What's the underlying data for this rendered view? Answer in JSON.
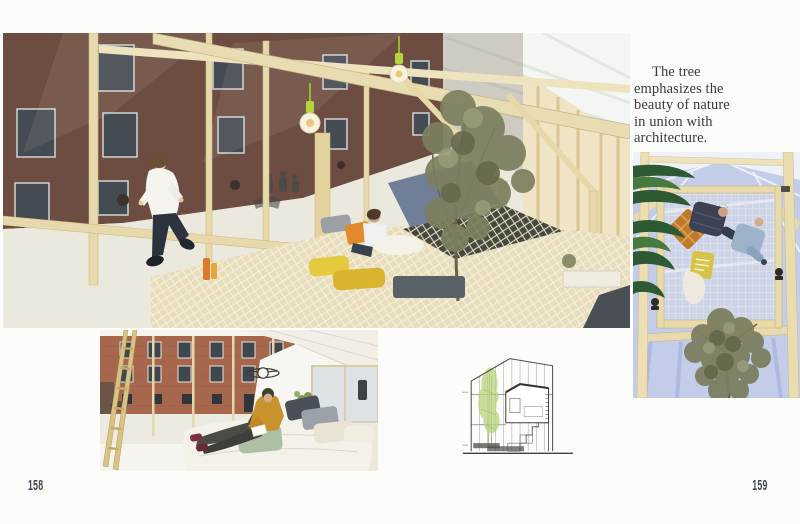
{
  "pages": {
    "left": "158",
    "right": "159"
  },
  "caption": {
    "full_text": "The tree emphasizes the beauty of nature in union with architecture.",
    "lines": [
      "The tree",
      "emphasizes the",
      "beauty of nature",
      "in union with",
      "architecture."
    ]
  },
  "photos": {
    "pavilion": {
      "description": "Boy running inside a timber-framed pavilion with translucent walls, hanging bulbs, a net floor with cushions, an olive tree and a brick building beyond"
    },
    "bedroom": {
      "description": "Man in a mustard sweater reading on a floor bed inside the cabin; ladder and brick courtyard seen through glazing; MINI wing logo on the wall"
    },
    "looking_up": {
      "description": "View straight up through the net loft where two people rest, with palm leaves, olive-tree canopy and sky through translucent roof panels"
    },
    "section_drawing": {
      "description": "Architectural cross-section of the gabled cabin with interior room, stair and green tree"
    }
  },
  "colors": {
    "page_bg": "#fcfcfa",
    "caption_text": "#3d3a35",
    "page_number": "#3e4450",
    "wood": "#e8dcb2",
    "brick_dark": "#6d4c41",
    "brick_light": "#a7674d",
    "sky_blue": "#c3cce9",
    "net": "#e7ddbd",
    "mustard": "#c8932d",
    "orange": "#e28a2a",
    "palm_green": "#2e5a33",
    "olive_green": "#7c7f5f",
    "drawing_green": "#b9d47e"
  }
}
